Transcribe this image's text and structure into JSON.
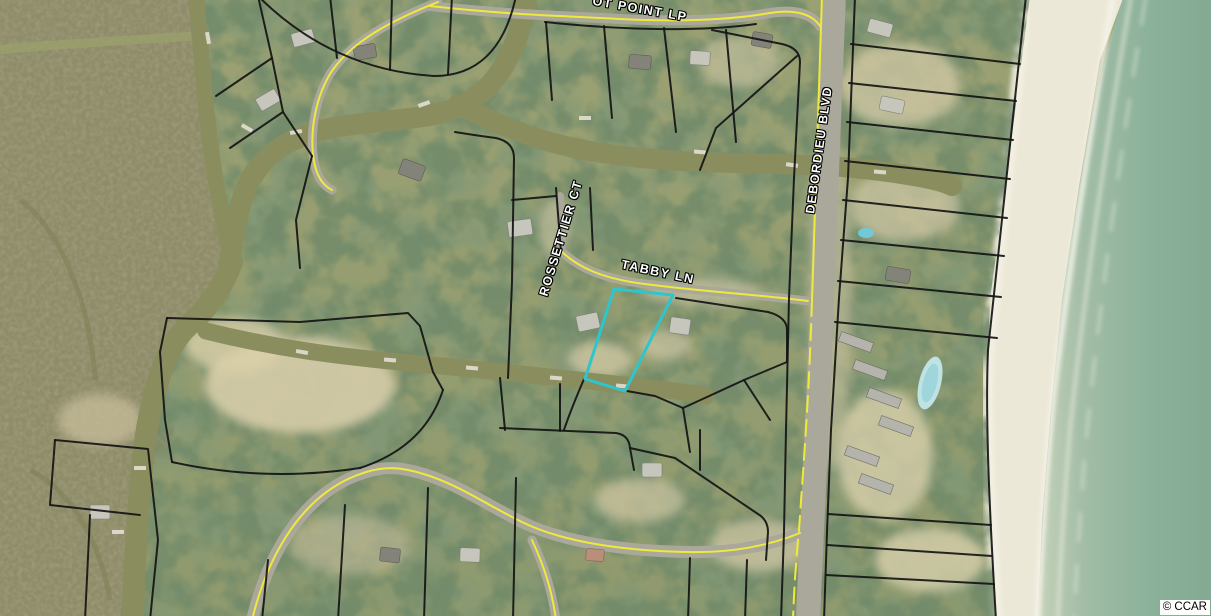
{
  "map": {
    "street_labels": {
      "ot_point_lp": "OT POINT LP",
      "rossettier_ct": "ROSSETTIER CT",
      "tabby_ln": "TABBY LN",
      "debordieu_blvd": "DEBORDIEU BLVD"
    },
    "copyright": "© CCAR",
    "highlight_parcel": {
      "points": "614,289 673,295 625,391 585,379",
      "color": "#2cc6cc"
    },
    "colors": {
      "parcel_line": "#141414",
      "road_centerline": "#eeea3c",
      "ocean": "#8cab97",
      "marsh": "#8f8c69",
      "beach": "#ece8d8",
      "canal_water": "#8a8e5f"
    }
  }
}
